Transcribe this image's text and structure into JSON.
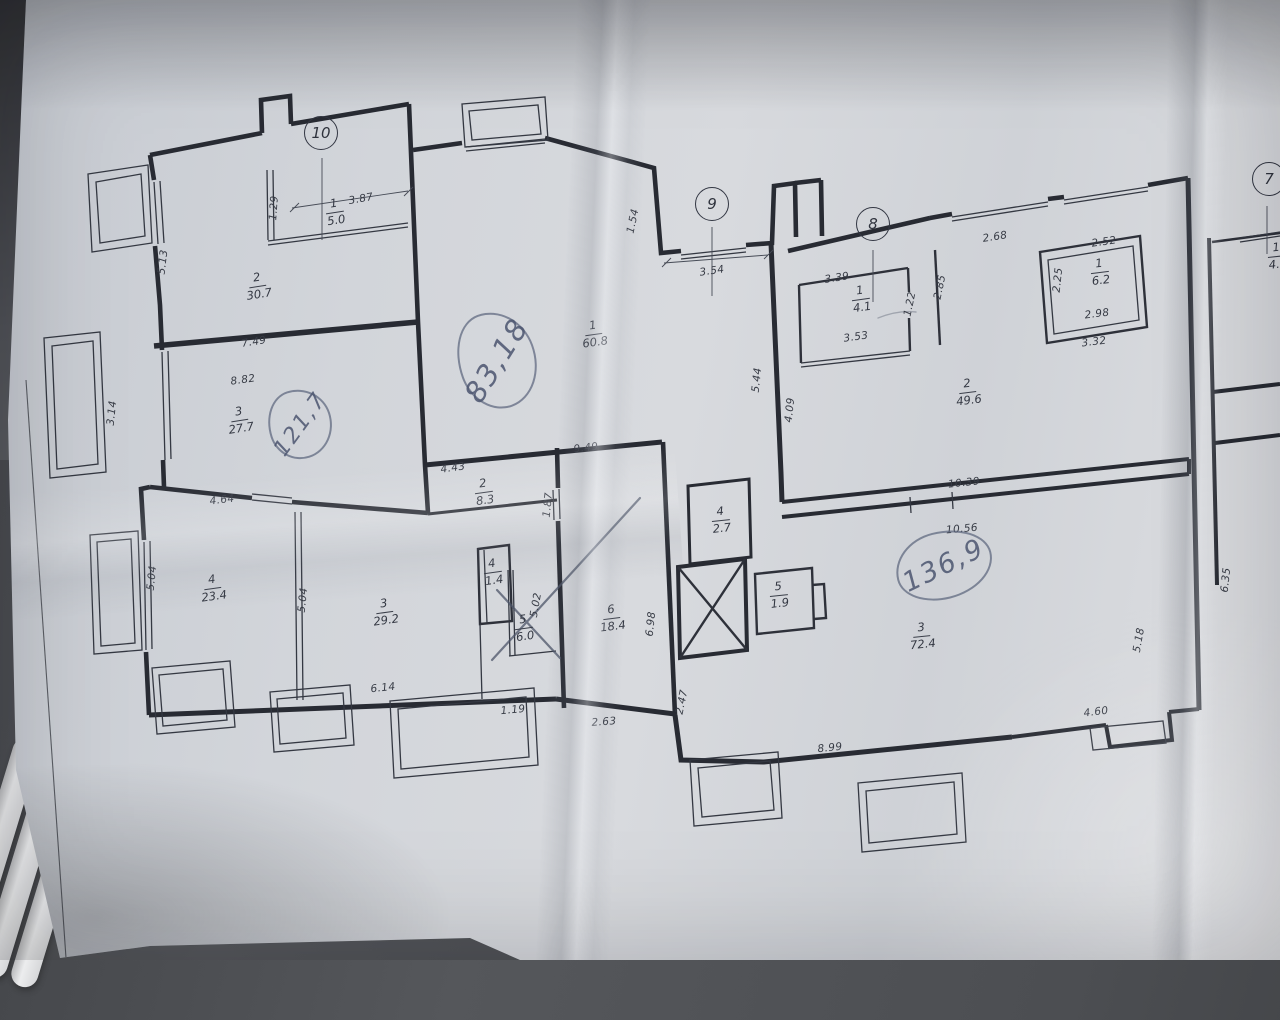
{
  "scene": {
    "description": "Photograph of a printed multi-apartment floor plan on creased paper with handwritten area totals",
    "paper_color": "#d4d7db",
    "background_color": "#4c4e52",
    "ink_color": "#2b2e36",
    "pen_color": "#55607a"
  },
  "plan": {
    "axis_markers": [
      {
        "label": "10",
        "x": 321,
        "y": 133
      },
      {
        "label": "9",
        "x": 712,
        "y": 204
      },
      {
        "label": "8",
        "x": 873,
        "y": 224
      },
      {
        "label": "7",
        "x": 1269,
        "y": 179
      }
    ],
    "rooms": [
      {
        "num": "1",
        "area": "5.0",
        "x": 335,
        "y": 212,
        "rot": -9
      },
      {
        "num": "2",
        "area": "30.7",
        "x": 258,
        "y": 286,
        "rot": -9
      },
      {
        "num": "3",
        "area": "27.7",
        "x": 240,
        "y": 420,
        "rot": -9
      },
      {
        "num": "4",
        "area": "23.4",
        "x": 213,
        "y": 588,
        "rot": -8
      },
      {
        "num": "3",
        "area": "29.2",
        "x": 385,
        "y": 612,
        "rot": -8
      },
      {
        "num": "4",
        "area": "1.4",
        "x": 493,
        "y": 572,
        "rot": -8
      },
      {
        "num": "5",
        "area": "6.0",
        "x": 524,
        "y": 628,
        "rot": -8
      },
      {
        "num": "2",
        "area": "8.3",
        "x": 484,
        "y": 492,
        "rot": -8
      },
      {
        "num": "6",
        "area": "18.4",
        "x": 612,
        "y": 618,
        "rot": -7
      },
      {
        "num": "1",
        "area": "60.8",
        "x": 594,
        "y": 334,
        "rot": -8
      },
      {
        "num": "4",
        "area": "2.7",
        "x": 721,
        "y": 520,
        "rot": -6
      },
      {
        "num": "5",
        "area": "1.9",
        "x": 779,
        "y": 595,
        "rot": -6
      },
      {
        "num": "3",
        "area": "72.4",
        "x": 922,
        "y": 636,
        "rot": -6
      },
      {
        "num": "2",
        "area": "49.6",
        "x": 968,
        "y": 392,
        "rot": -7
      },
      {
        "num": "1",
        "area": "4.1",
        "x": 861,
        "y": 299,
        "rot": -8
      },
      {
        "num": "1",
        "area": "6.2",
        "x": 1100,
        "y": 272,
        "rot": -7
      },
      {
        "num": "1",
        "area": "4.5",
        "x": 1277,
        "y": 256,
        "rot": -6
      }
    ],
    "dimensions": [
      {
        "text": "1.29",
        "x": 274,
        "y": 208,
        "rot": -86
      },
      {
        "text": "3.87",
        "x": 361,
        "y": 199,
        "rot": -10
      },
      {
        "text": "5.13",
        "x": 163,
        "y": 262,
        "rot": -83
      },
      {
        "text": "7.49",
        "x": 254,
        "y": 342,
        "rot": -9
      },
      {
        "text": "8.82",
        "x": 243,
        "y": 380,
        "rot": -8
      },
      {
        "text": "3.14",
        "x": 112,
        "y": 413,
        "rot": -84
      },
      {
        "text": "4.64",
        "x": 222,
        "y": 500,
        "rot": -7
      },
      {
        "text": "5.04",
        "x": 152,
        "y": 578,
        "rot": -84
      },
      {
        "text": "5.04",
        "x": 303,
        "y": 600,
        "rot": -84
      },
      {
        "text": "6.14",
        "x": 383,
        "y": 688,
        "rot": -6
      },
      {
        "text": "1.19",
        "x": 513,
        "y": 710,
        "rot": -5
      },
      {
        "text": "5.02",
        "x": 536,
        "y": 605,
        "rot": -80
      },
      {
        "text": "1.87",
        "x": 548,
        "y": 505,
        "rot": -84
      },
      {
        "text": "4.43",
        "x": 453,
        "y": 468,
        "rot": -8
      },
      {
        "text": "9.49",
        "x": 586,
        "y": 448,
        "rot": -7
      },
      {
        "text": "2.63",
        "x": 604,
        "y": 722,
        "rot": -4
      },
      {
        "text": "6.98",
        "x": 651,
        "y": 624,
        "rot": -84
      },
      {
        "text": "2.47",
        "x": 682,
        "y": 702,
        "rot": -78
      },
      {
        "text": "1.54",
        "x": 633,
        "y": 221,
        "rot": -78
      },
      {
        "text": "3.54",
        "x": 712,
        "y": 271,
        "rot": -8
      },
      {
        "text": "5.44",
        "x": 757,
        "y": 380,
        "rot": -84
      },
      {
        "text": "4.09",
        "x": 790,
        "y": 410,
        "rot": -84
      },
      {
        "text": "3.39",
        "x": 837,
        "y": 278,
        "rot": -9
      },
      {
        "text": "3.53",
        "x": 856,
        "y": 337,
        "rot": -8
      },
      {
        "text": "1.22",
        "x": 910,
        "y": 304,
        "rot": -78
      },
      {
        "text": "2.85",
        "x": 940,
        "y": 287,
        "rot": -78
      },
      {
        "text": "2.68",
        "x": 995,
        "y": 237,
        "rot": -9
      },
      {
        "text": "2.52",
        "x": 1104,
        "y": 242,
        "rot": -8
      },
      {
        "text": "2.25",
        "x": 1058,
        "y": 280,
        "rot": -84
      },
      {
        "text": "2.98",
        "x": 1097,
        "y": 314,
        "rot": -7
      },
      {
        "text": "3.32",
        "x": 1094,
        "y": 342,
        "rot": -7
      },
      {
        "text": "10.39",
        "x": 964,
        "y": 483,
        "rot": -6
      },
      {
        "text": "10.56",
        "x": 962,
        "y": 529,
        "rot": -5
      },
      {
        "text": "8.99",
        "x": 830,
        "y": 748,
        "rot": -6
      },
      {
        "text": "4.60",
        "x": 1096,
        "y": 712,
        "rot": -7
      },
      {
        "text": "5.18",
        "x": 1139,
        "y": 640,
        "rot": -80
      },
      {
        "text": "6.35",
        "x": 1226,
        "y": 580,
        "rot": -84
      }
    ],
    "handwritten": [
      {
        "text": "83,18",
        "x": 497,
        "y": 360,
        "rot": -20,
        "text_rot": -38,
        "w": 74,
        "h": 94,
        "size": 29
      },
      {
        "text": "121,7",
        "x": 300,
        "y": 424,
        "rot": -18,
        "text_rot": -36,
        "w": 60,
        "h": 66,
        "size": 22
      },
      {
        "text": "136,9",
        "x": 944,
        "y": 565,
        "rot": -14,
        "text_rot": -12,
        "w": 94,
        "h": 64,
        "size": 27
      }
    ]
  }
}
